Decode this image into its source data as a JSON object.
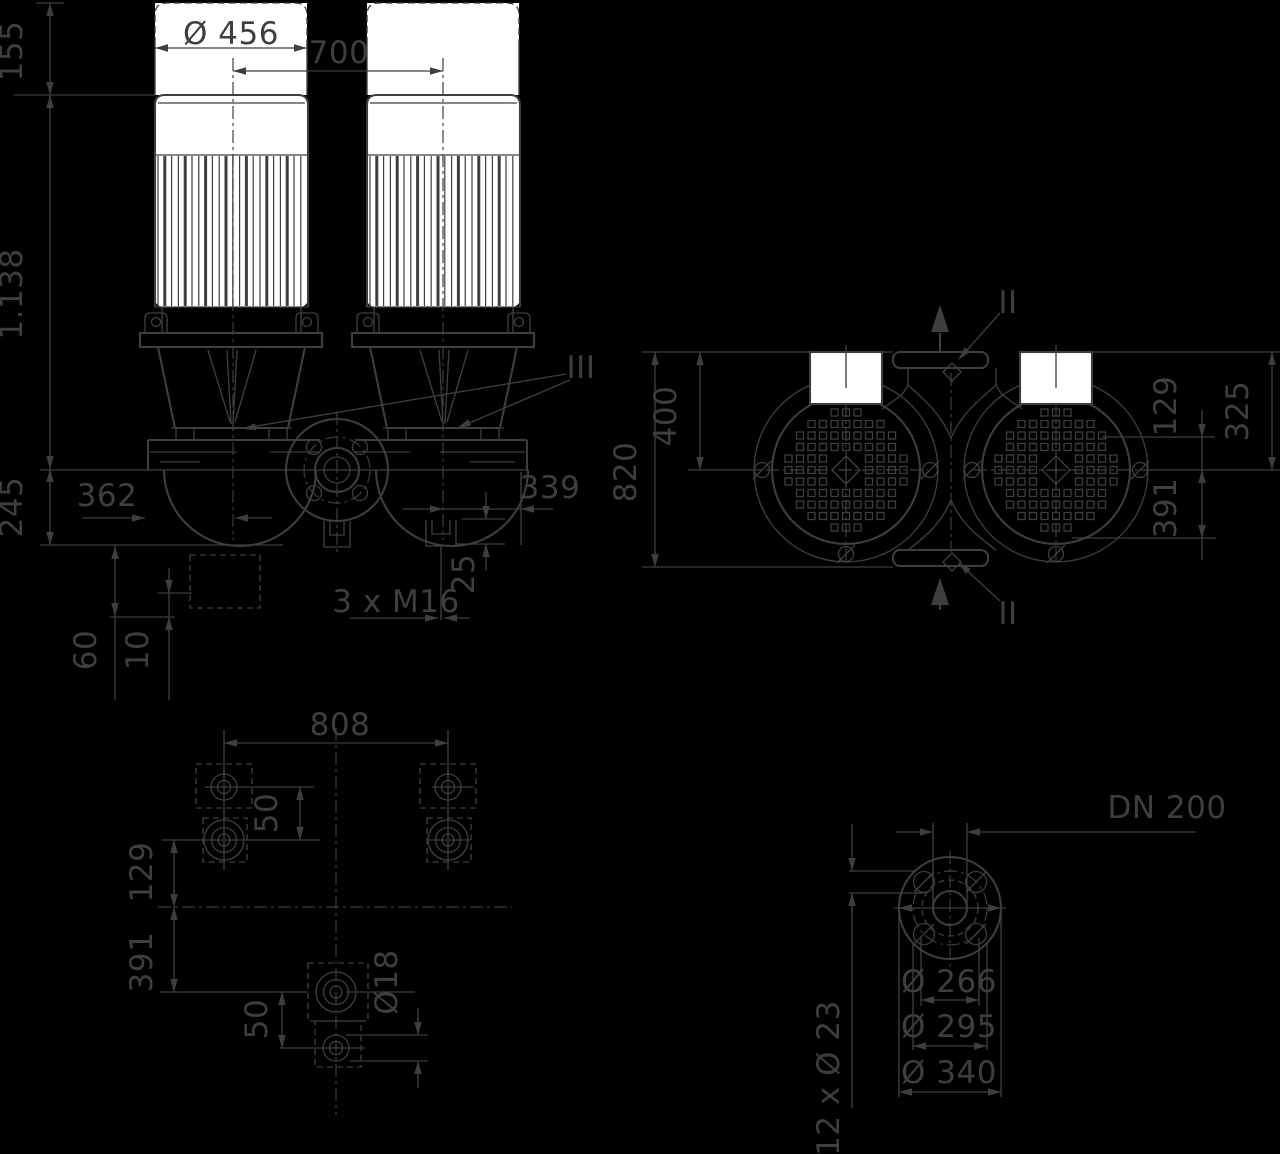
{
  "colors": {
    "background": "#000000",
    "line": "#3E3E3D",
    "mask_fill": "#FFFFFF"
  },
  "views": {
    "front": {
      "name": "front elevation",
      "dims": {
        "d155": "155",
        "d456": "Ø 456",
        "d700": "700",
        "d1138": "1.138",
        "d245": "245",
        "d362": "362",
        "d339": "339",
        "d3xm16": "3 x M16",
        "d25": "25",
        "d60": "60",
        "d10": "10",
        "section_iii": "III"
      }
    },
    "top": {
      "name": "top view",
      "dims": {
        "d820": "820",
        "d400": "400",
        "d129": "129",
        "d325": "325",
        "d391": "391",
        "section_ii_top": "II",
        "section_ii_bottom": "II"
      }
    },
    "plan": {
      "name": "foundation plan",
      "dims": {
        "d808": "808",
        "d50_upper": "50",
        "d129": "129",
        "d391": "391",
        "d50_lower": "50",
        "d18": "Ø18"
      }
    },
    "flange": {
      "name": "flange detail",
      "dims": {
        "dn": "DN 200",
        "d266": "Ø 266",
        "d295": "Ø 295",
        "d340": "Ø 340",
        "d12x23": "12 x Ø 23"
      }
    }
  }
}
